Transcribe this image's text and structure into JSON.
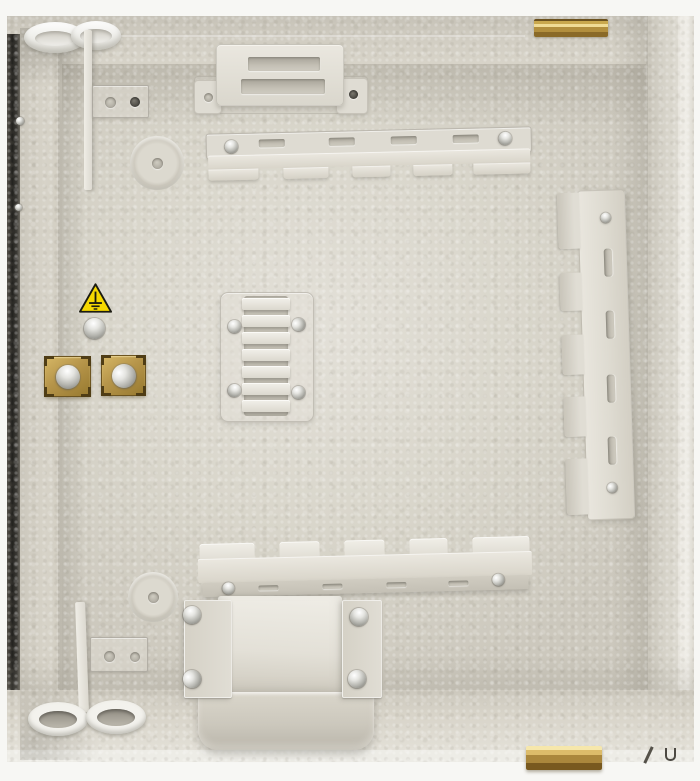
{
  "meta": {
    "title": "Distribution cabinet interior - product photo",
    "subject": "Empty beige wall-mount fibre/electrical distribution box, back panel with mounting hardware"
  },
  "palette": {
    "body_beige": "#d7d3c8",
    "panel_highlight": "#e3e0d8",
    "panel_shadow": "#c7c3b8",
    "bracket_metal": "#e6e3db",
    "brass": "#b8943f",
    "steel_screw": "#c9c9c4",
    "warning_yellow": "#f6d800",
    "edge_dark": "#23221f",
    "backdrop_white": "#f7f7f4"
  },
  "components": {
    "enclosure": {
      "label": "Sheet-metal enclosure, beige hammered finish"
    },
    "grommets_top": {
      "label": "Cable entry grommets, top left",
      "count": 2
    },
    "grommets_bottom": {
      "label": "Cable entry grommets, bottom left",
      "count": 2
    },
    "hinge_top": {
      "label": "Brass hinge, top edge"
    },
    "hinge_bottom": {
      "label": "Brass hinge, bottom edge"
    },
    "mounting_bracket_top": {
      "label": "Raised mounting bracket with two slots"
    },
    "cable_rail_top": {
      "label": "Notched cable routing rail, upper"
    },
    "cable_rail_bottom": {
      "label": "Notched cable routing rail, lower"
    },
    "cable_rail_right": {
      "label": "Notched cable routing rail, vertical right"
    },
    "cable_comb_center": {
      "label": "Cable management comb, center"
    },
    "earth_warning": {
      "label": "Earth ground warning label"
    },
    "earth_screw": {
      "label": "Earthing screw"
    },
    "cable_clamps": {
      "label": "Brass cable clamps",
      "count": 2
    },
    "u_channel": {
      "label": "U-shaped cable guide channel"
    },
    "knockout_top": {
      "label": "Circular knockout, upper left"
    },
    "knockout_bottom": {
      "label": "Circular knockout, lower left"
    },
    "plate_top": {
      "label": "Small plate with two holes, upper left"
    },
    "plate_bottom": {
      "label": "Small plate with two holes, lower left"
    },
    "divider_top": {
      "label": "Thin divider strip, upper left"
    },
    "divider_bottom": {
      "label": "Thin divider strip, lower left"
    },
    "watermark": {
      "label": "Small dark marks, bottom right"
    }
  }
}
